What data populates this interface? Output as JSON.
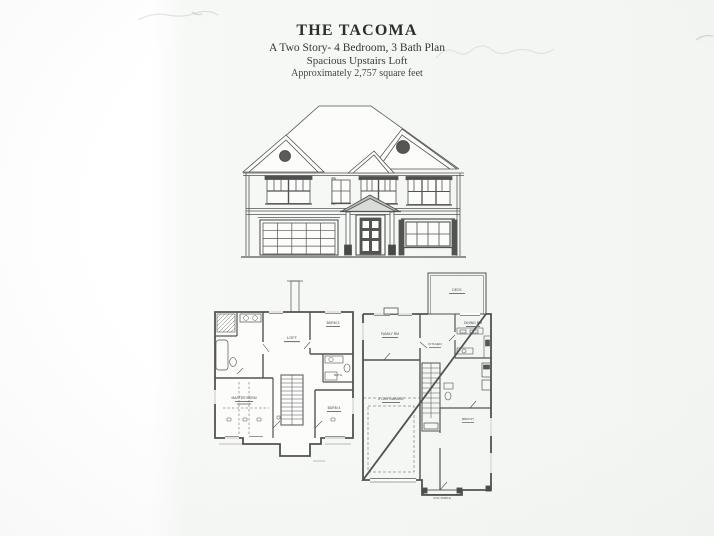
{
  "document": {
    "title": "THE TACOMA",
    "subtitle": "A Two Story- 4 Bedroom, 3 Bath Plan",
    "tagline": "Spacious Upstairs Loft",
    "area": "Approximately 2,757 square feet"
  },
  "colors": {
    "ink": "#454746",
    "paper": "#f6f8f6"
  },
  "floorplans": {
    "second_floor": {
      "loft": "LOFT",
      "master": "MASTER BDRM",
      "bdrm3": "BDRM 3",
      "bdrm4": "BDRM 4",
      "bath": "BATH"
    },
    "first_floor": {
      "deck": "DECK",
      "family": "FAMILY RM",
      "dining": "DINING RM",
      "kitchen": "KITCHEN",
      "garage": "2 CAR GARAGE",
      "brkfst": "BRKFST",
      "porch": "COV. PORCH"
    }
  }
}
